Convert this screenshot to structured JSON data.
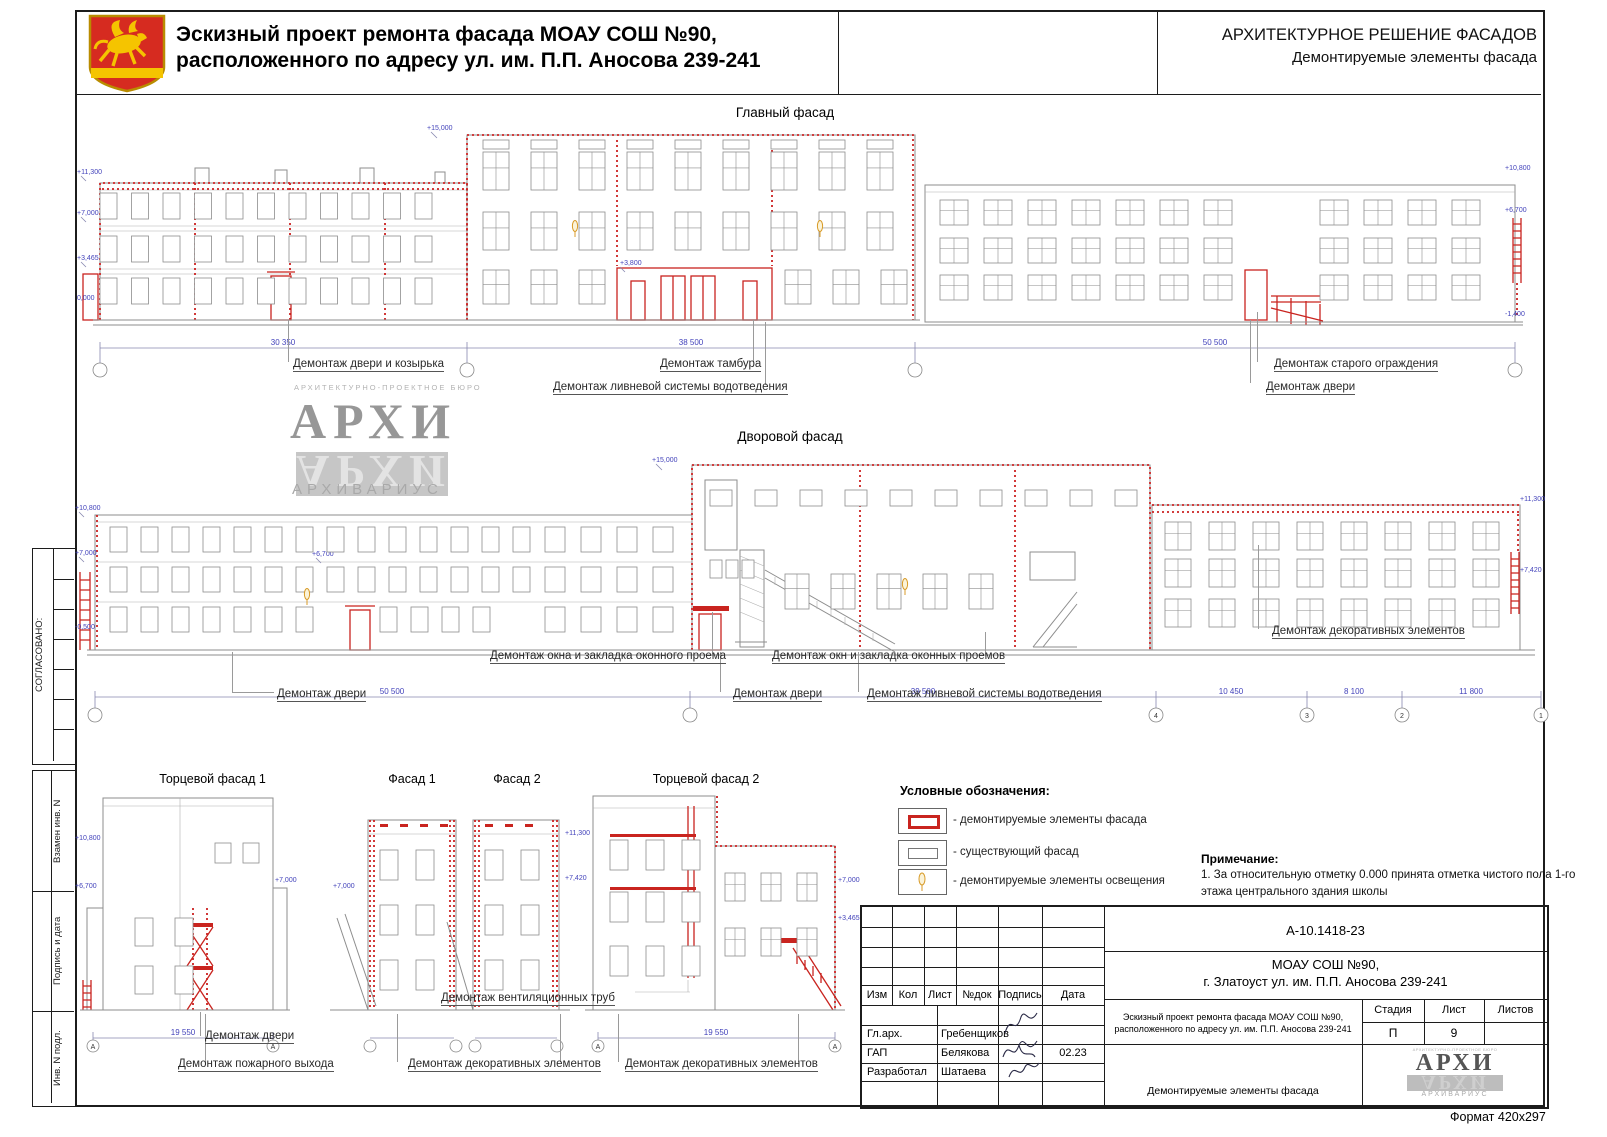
{
  "header": {
    "title_line1": "Эскизный проект ремонта фасада МОАУ СОШ №90,",
    "title_line2": "расположенного по адресу ул. им. П.П. Аносова 239-241",
    "right_title": "АРХИТЕКТУРНОЕ РЕШЕНИЕ ФАСАДОВ",
    "right_subtitle": "Демонтируемые элементы фасада"
  },
  "margin": {
    "approved": "СОГЛАСОВАНО:",
    "replace_inv": "Взамен инв. N",
    "sign_date": "Подпись и дата",
    "inv_no": "Инв. N подл."
  },
  "watermark": {
    "bureau": "АРХИТЕКТУРНО-ПРОЕКТНОЕ БЮРО",
    "name": "АРХИ",
    "subname": "АРХИВАРИУС"
  },
  "main_facade": {
    "title": "Главный фасад",
    "labels": {
      "door_canopy": "Демонтаж двери и козырька",
      "tambour": "Демонтаж тамбура",
      "drain": "Демонтаж ливневой системы водотведения",
      "old_fence": "Демонтаж старого ограждения",
      "door": "Демонтаж двери"
    },
    "dims": [
      "30 350",
      "38 500",
      "50 500"
    ],
    "elev": {
      "e15000": "+15,000",
      "e11300": "+11,300",
      "e7000": "+7,000",
      "e3465": "+3,465",
      "e0": "0,000",
      "e3800": "+3,800",
      "e10800": "+10,800",
      "e6700": "+6,700",
      "em1400": "-1,400"
    }
  },
  "yard_facade": {
    "title": "Дворовой фасад",
    "labels": {
      "window1": "Демонтаж окна и закладка оконного проема",
      "windows2": "Демонтаж окн и закладка оконных проемов",
      "deco": "Демонтаж декоративных элементов",
      "door_left": "Демонтаж двери",
      "door_mid": "Демонтаж двери",
      "drain": "Демонтаж ливневой системы водотведения"
    },
    "dims": [
      "50 500",
      "39 500",
      "10 450",
      "8 100",
      "11 800"
    ],
    "axes": [
      "4",
      "3",
      "2",
      "1"
    ],
    "elev": {
      "e15000": "+15,000",
      "e10800": "+10,800",
      "e7000": "+7,000",
      "e6700": "+6,700",
      "em0500": "-0,500",
      "e11300": "+11,300",
      "e7420": "+7,420"
    }
  },
  "small_facades": {
    "titles": {
      "end1": "Торцевой фасад 1",
      "f1": "Фасад 1",
      "f2": "Фасад 2",
      "end2": "Торцевой фасад 2"
    },
    "labels": {
      "door": "Демонтаж двери",
      "fire_exit": "Демонтаж пожарного выхода",
      "vent": "Демонтаж вентиляционных труб",
      "deco1": "Демонтаж декоративных элементов",
      "deco2": "Демонтаж декоративных элементов"
    },
    "dims": [
      "19 550",
      "19 550"
    ],
    "axis": "А",
    "elev": {
      "e10800": "+10,800",
      "e6700": "+6,700",
      "e7000a": "+7,000",
      "e7000b": "+7,000",
      "e11300": "+11,300",
      "e7420": "+7,420",
      "e7000c": "+7,000",
      "e3465": "+3,465"
    }
  },
  "legend": {
    "title": "Условные обозначения:",
    "item1": "- демонтируемые элементы фасада",
    "item2": "- существующий фасад",
    "item3": "- демонтируемые элементы освещения"
  },
  "note": {
    "title": "Примечание:",
    "line1": "1. За относительную отметку 0.000 принята отметка чистого пола 1-го",
    "line2": "этажа центрального здания школы"
  },
  "title_block": {
    "doc_number": "А-10.1418-23",
    "object_line1": "МОАУ СОШ №90,",
    "object_line2": "г. Златоуст ул. им. П.П. Аносова 239-241",
    "cols": {
      "izm": "Изм",
      "kol": "Кол",
      "list": "Лист",
      "doc": "№док",
      "sign": "Подпись",
      "date": "Дата"
    },
    "rows": [
      {
        "role": "Гл.арх.",
        "name": "Гребенщиков",
        "date": ""
      },
      {
        "role": "ГАП",
        "name": "Белякова",
        "date": "02.23"
      },
      {
        "role": "Разработал",
        "name": "Шатаева",
        "date": ""
      }
    ],
    "project_line1": "Эскизный проект ремонта фасада МОАУ СОШ №90,",
    "project_line2": "расположенного по адресу ул. им. П.П. Аносова 239-241",
    "stage_label": "Стадия",
    "sheet_label": "Лист",
    "sheets_label": "Листов",
    "stage_value": "П",
    "sheet_value": "9",
    "sheets_value": "",
    "sheet_title": "Демонтируемые элементы фасада"
  },
  "format_label": "Формат 420х297"
}
